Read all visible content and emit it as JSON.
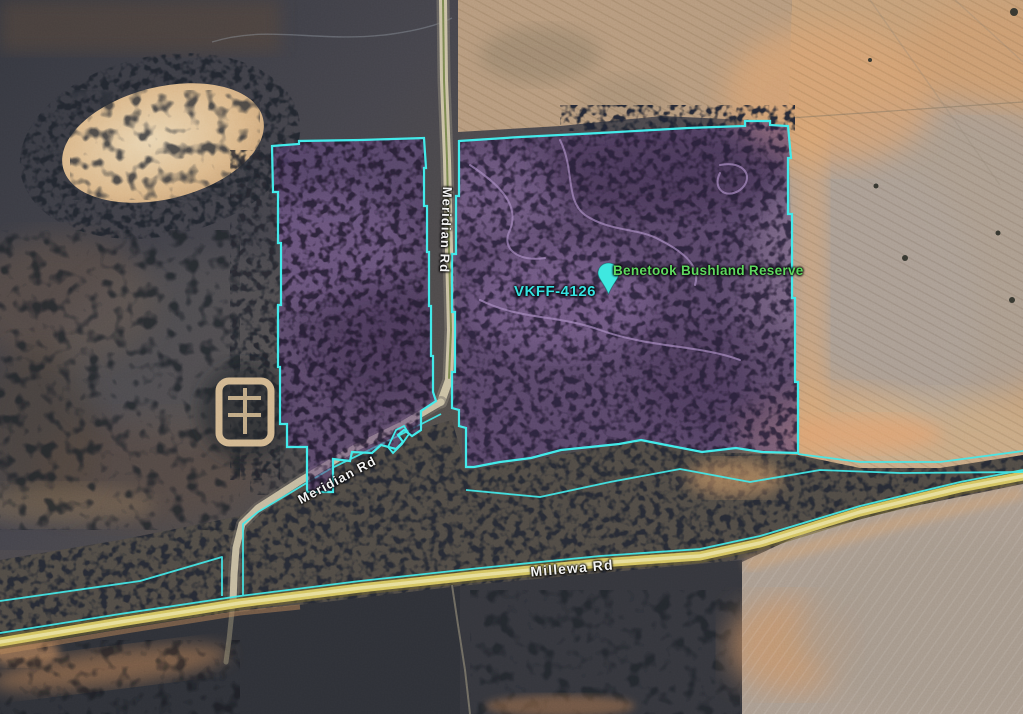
{
  "map": {
    "view": "satellite",
    "place": {
      "name": "Benetook Bushland Reserve",
      "code": "VKFF-4126"
    },
    "roads": {
      "meridian": "Meridian Rd",
      "millewa": "Millewa Rd"
    },
    "marker": {
      "label": "Benetook Bushland Reserve placemark"
    },
    "colors": {
      "boundary": "#3FE9E9",
      "reserve_fill": "#63467E",
      "place_name": "#5FD95F",
      "place_code": "#35E2E2",
      "road_label": "#F2F2F2",
      "marker": "#3FE8E0",
      "road_highlight": "#D6C868"
    }
  }
}
